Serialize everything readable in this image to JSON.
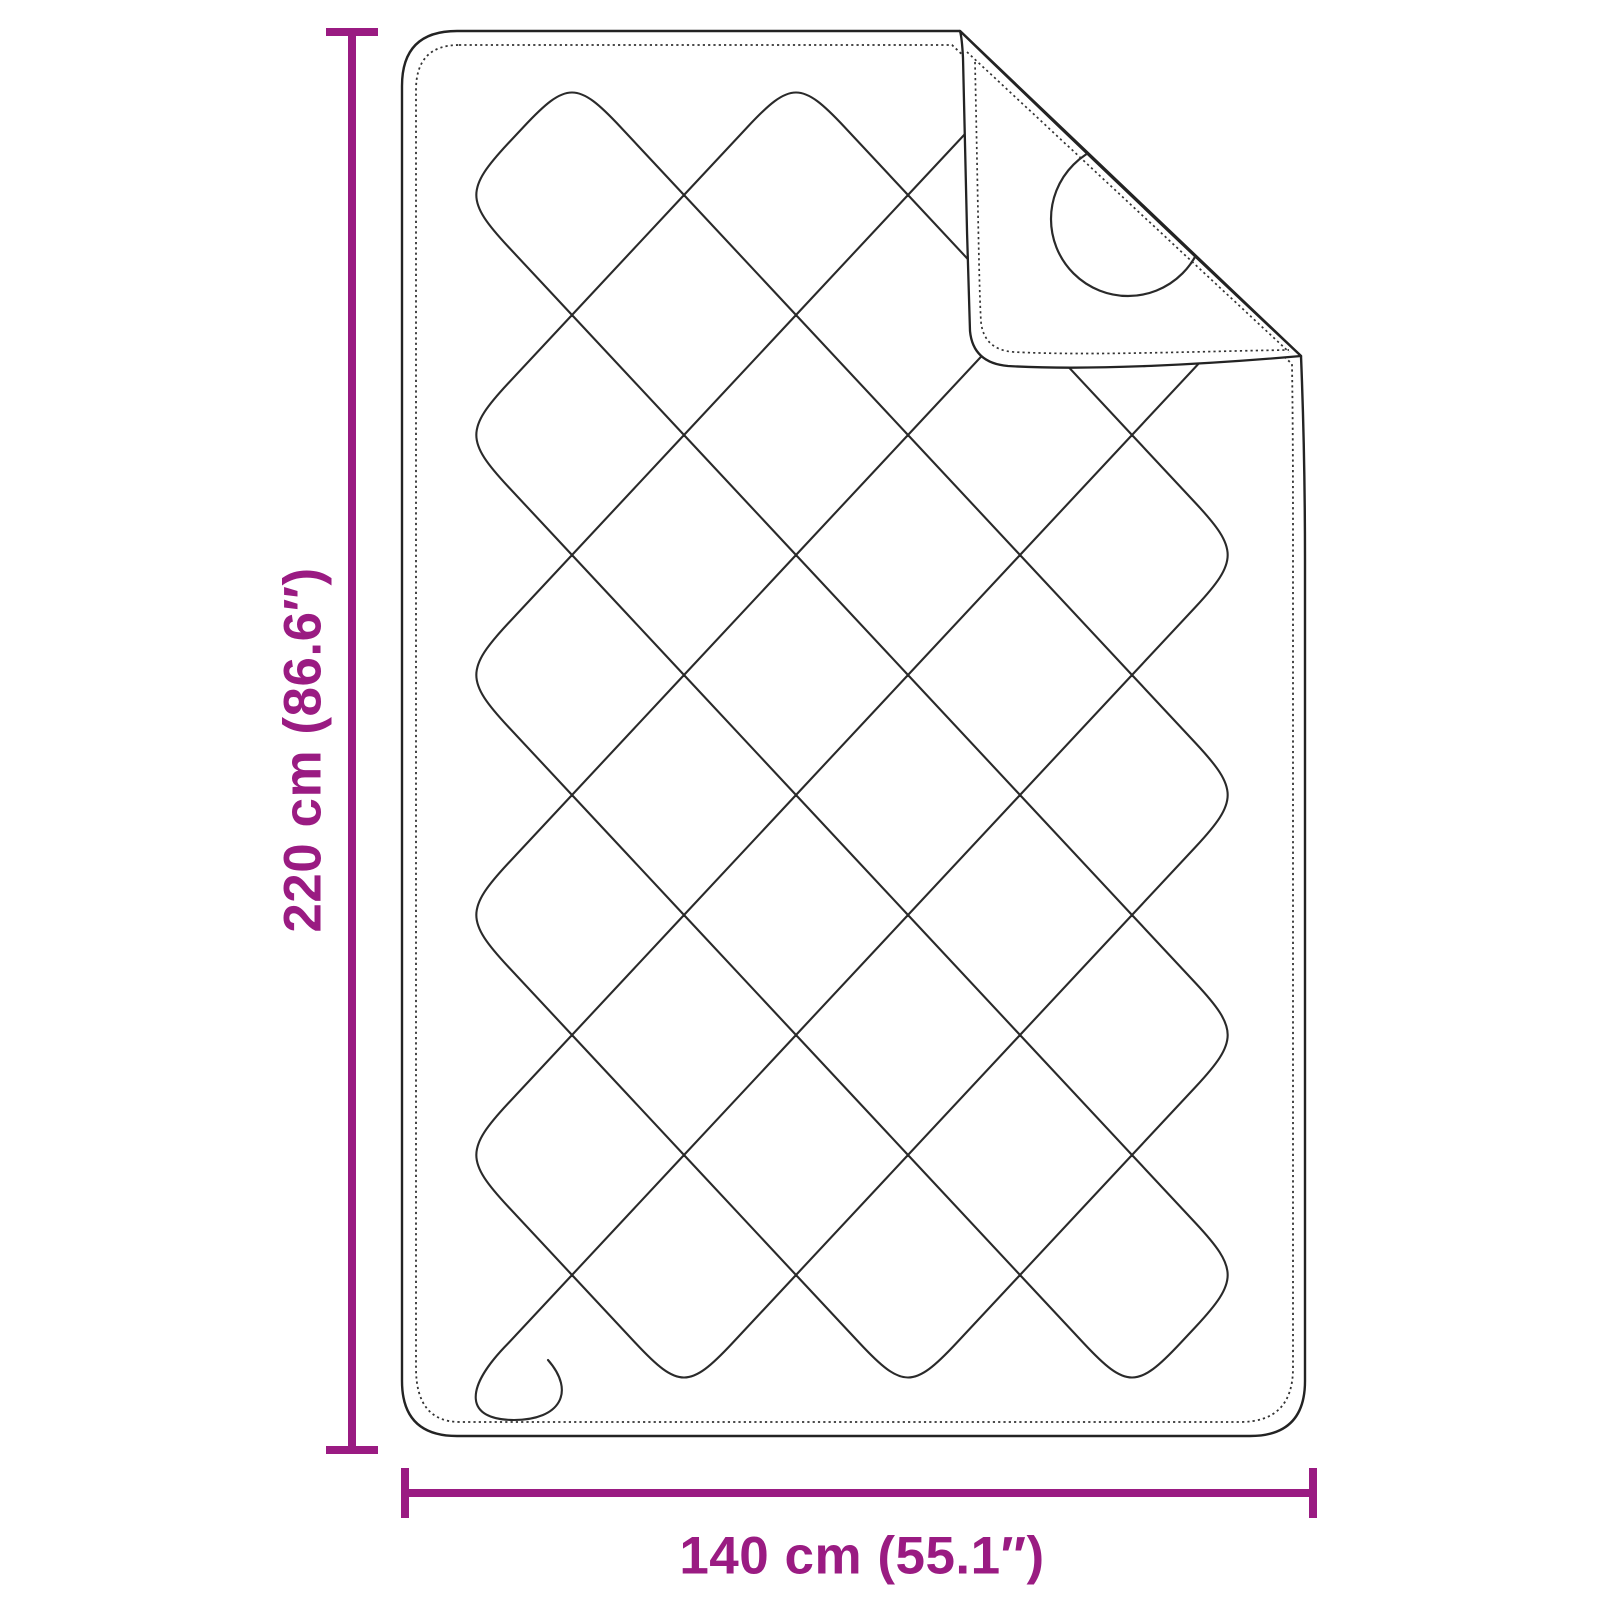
{
  "figure": {
    "description": "Line drawing of a quilted blanket with diamond stitching and a folded-over top-right corner showing a circular stitch on the reverse side",
    "height_label": "220 cm (86.6″)",
    "width_label": "140 cm (55.1″)"
  },
  "colors": {
    "dimension_accent": "#9A1B82",
    "line": "#232323",
    "stitch": "#333333",
    "background": "#FFFFFF"
  }
}
